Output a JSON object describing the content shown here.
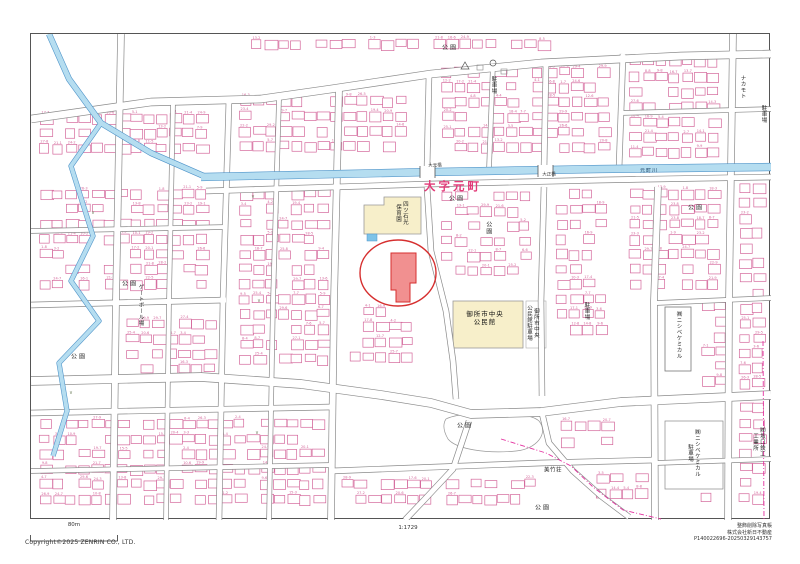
{
  "footer": {
    "scale_bar_label": "80m",
    "scale_ratio": "1:1729",
    "copyright": "Copyright©2025 ZENRIN CO., LTD.",
    "credit_line1": "整飾削除写真帳",
    "credit_line2": "株式会社新日不動産",
    "credit_line3": "P140022696-20250329143757"
  },
  "colors": {
    "highlight_red": "#d62f2f",
    "highlight_fill": "#ee7d7d",
    "building_pink": "#d4679b",
    "river_fill": "#b5ddf0",
    "river_edge": "#4f94c9",
    "boundary_magenta": "#e332a0",
    "public_cream": "#f7efca",
    "oaza_red": "#e23a78",
    "road_edge": "#8a8a8a"
  },
  "map": {
    "labels": [
      {
        "name": "oaza-title-label",
        "text": "大字元町",
        "x": 452,
        "y": 186,
        "cls": "oaza"
      },
      {
        "name": "park-label",
        "text": "公園",
        "x": 449,
        "y": 47
      },
      {
        "name": "park-label",
        "text": "公園",
        "x": 456,
        "y": 198
      },
      {
        "name": "park-label",
        "text": "公園",
        "x": 487,
        "y": 227,
        "v": 1
      },
      {
        "name": "park-label",
        "text": "公園",
        "x": 129,
        "y": 283
      },
      {
        "name": "gateball-field-label",
        "text": "ゲートボール場",
        "x": 139,
        "y": 304,
        "v": 1,
        "cls": "sm"
      },
      {
        "name": "park-label",
        "text": "公園",
        "x": 78,
        "y": 356
      },
      {
        "name": "park-label",
        "text": "公園",
        "x": 695,
        "y": 207
      },
      {
        "name": "park-label",
        "text": "公園",
        "x": 464,
        "y": 425
      },
      {
        "name": "park-label",
        "text": "公園",
        "x": 542,
        "y": 507
      },
      {
        "name": "nakamoto-label",
        "text": "ナカモト",
        "x": 741,
        "y": 86,
        "v": 1,
        "cls": "sm"
      },
      {
        "name": "nishibe-chemical-label",
        "text": "㈱ニシベケミカル",
        "x": 677,
        "y": 334,
        "v": 1,
        "cls": "sm"
      },
      {
        "name": "nishibe-chemical-parking-label",
        "text": "㈱ニシベケミカル\n駐車場",
        "x": 692,
        "y": 452,
        "v": 1,
        "cls": "sm"
      },
      {
        "name": "sakaguchi-works-label",
        "text": "㈱坂口鉄工\n工業所",
        "x": 757,
        "y": 441,
        "v": 1,
        "cls": "sm"
      },
      {
        "name": "parking-label",
        "text": "駐車場",
        "x": 492,
        "y": 84,
        "v": 1,
        "cls": "sm"
      },
      {
        "name": "parking-label",
        "text": "駐車場",
        "x": 585,
        "y": 310,
        "v": 1,
        "cls": "sm"
      },
      {
        "name": "parking-label",
        "text": "駐車場",
        "x": 762,
        "y": 113,
        "v": 1,
        "cls": "sm"
      },
      {
        "name": "nursery-school-label",
        "text": "四ツ石光\n保育園",
        "x": 400,
        "y": 212,
        "v": 1,
        "cls": "sm"
      },
      {
        "name": "community-center-label",
        "text": "御所市中央\n公民館",
        "x": 484,
        "y": 318,
        "cls": "pub"
      },
      {
        "name": "community-center-parking-label",
        "text": "御所市中央\n公民館駐車場",
        "x": 531,
        "y": 322,
        "v": 1,
        "cls": "sm"
      },
      {
        "name": "mitakeso-label",
        "text": "美竹荘",
        "x": 552,
        "y": 470,
        "cls": "sm"
      },
      {
        "name": "omoto-bridge-label",
        "text": "大元橋",
        "x": 434,
        "y": 165,
        "cls": "br"
      },
      {
        "name": "taisho-bridge-label",
        "text": "大正橋",
        "x": 548,
        "y": 174,
        "cls": "br"
      },
      {
        "name": "motomachi-river-label",
        "text": "元町川",
        "x": 648,
        "y": 170,
        "cls": "riv"
      },
      {
        "name": "grass-symbol",
        "text": "∨",
        "x": 252,
        "y": 196,
        "cls": "sym"
      },
      {
        "name": "grass-symbol",
        "text": "∨",
        "x": 92,
        "y": 212,
        "cls": "sym"
      },
      {
        "name": "grass-symbol",
        "text": "∨",
        "x": 70,
        "y": 392,
        "cls": "sym"
      },
      {
        "name": "grass-symbol",
        "text": "∨",
        "x": 258,
        "y": 300,
        "cls": "sym"
      },
      {
        "name": "grass-symbol",
        "text": "∨",
        "x": 256,
        "y": 432,
        "cls": "sym"
      }
    ]
  }
}
